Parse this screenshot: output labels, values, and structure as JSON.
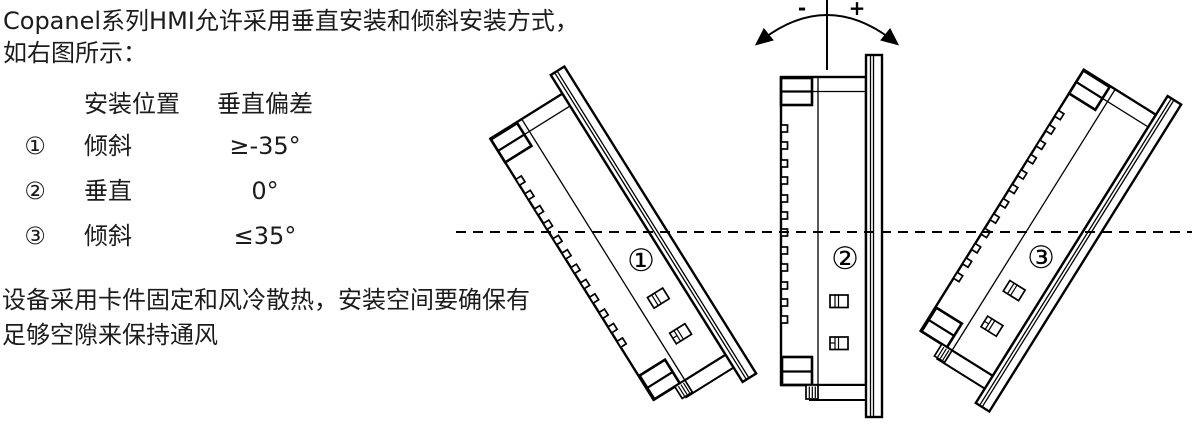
{
  "intro": {
    "line1": "Copanel系列HMI允许采用垂直安装和倾斜安装方式，",
    "line2": "如右图所示："
  },
  "table": {
    "headers": [
      "安装位置",
      "垂直偏差"
    ],
    "rows": [
      {
        "num": "①",
        "position": "倾斜",
        "deviation": "≥-35°"
      },
      {
        "num": "②",
        "position": "垂直",
        "deviation": "0°"
      },
      {
        "num": "③",
        "position": "倾斜",
        "deviation": "≤35°"
      }
    ]
  },
  "note": {
    "line1": "设备采用卡件固定和风冷散热，安装空间要确保有",
    "line2": "足够空隙来保持通风"
  },
  "diagram": {
    "minus_label": "-",
    "plus_label": "+",
    "device_labels": [
      "①",
      "②",
      "③"
    ],
    "tilt_angles_deg": [
      -32,
      0,
      32
    ],
    "colors": {
      "line": "#000000",
      "background": "#ffffff",
      "text": "#1c1c1c"
    }
  }
}
